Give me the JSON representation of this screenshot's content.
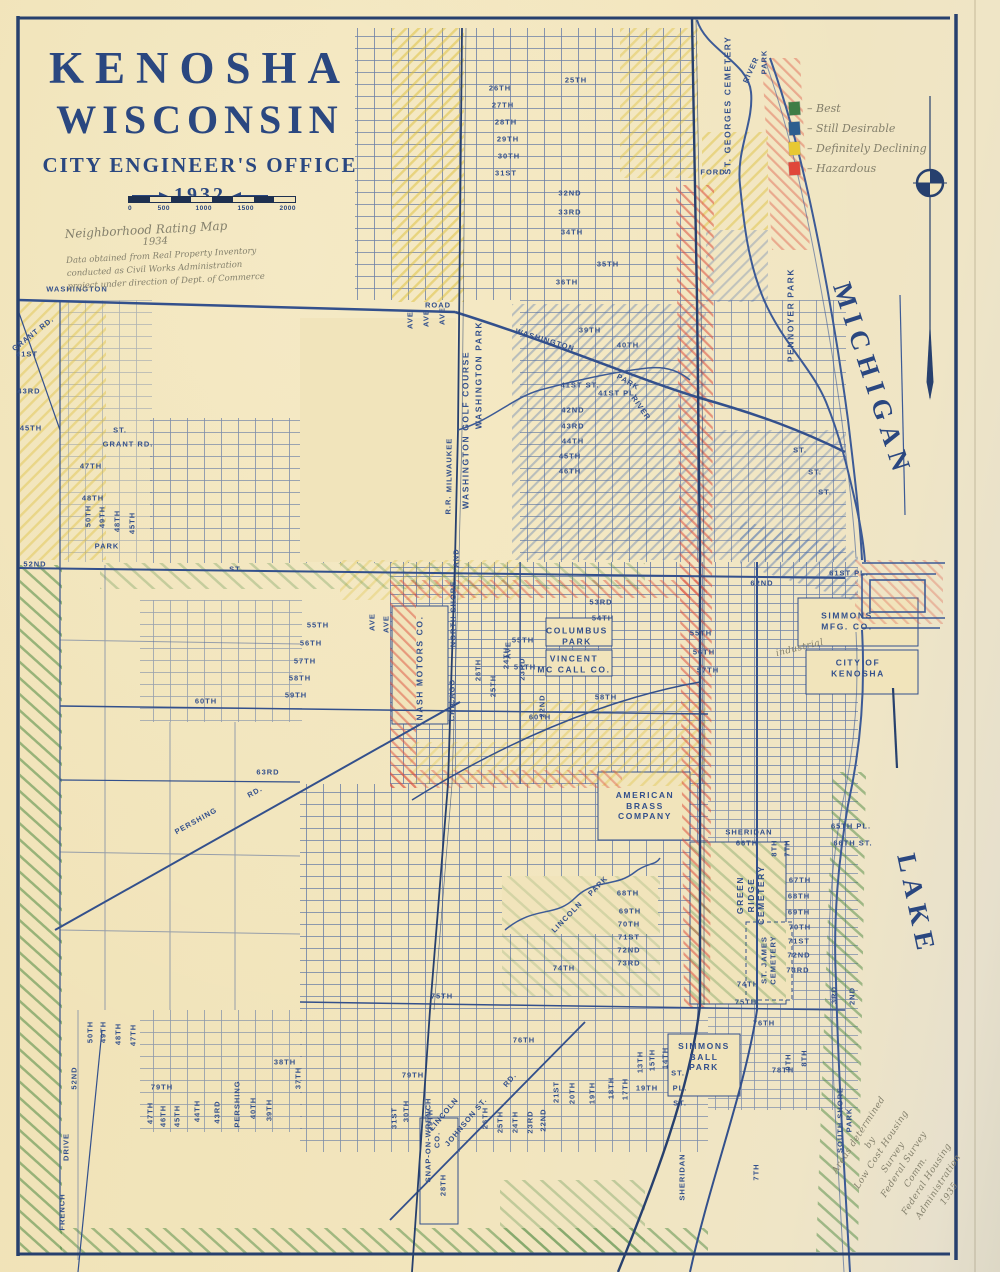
{
  "title": {
    "line1": "KENOSHA",
    "line2": "WISCONSIN",
    "office": "CITY ENGINEER'S OFFICE",
    "year": "1932"
  },
  "scale": {
    "ticks": [
      "0",
      "500",
      "1000",
      "1500",
      "2000"
    ]
  },
  "notes": {
    "top_title": "Neighborhood Rating Map",
    "top_year": "1934",
    "top_body": "Data obtained from Real Property Inventory\nconducted as Civil Works Administration\nproject under direction of Dept. of Commerce"
  },
  "legend": {
    "prefix": "– ",
    "items": [
      {
        "label": "Best",
        "color": "#3f7d46"
      },
      {
        "label": "Still Desirable",
        "color": "#2d5e8f"
      },
      {
        "label": "Definitely Declining",
        "color": "#e7c832"
      },
      {
        "label": "Hazardous",
        "color": "#e0473a"
      }
    ]
  },
  "colors": {
    "ink": "#2a4780",
    "street": "#33508c",
    "paper": "#f1e4bb",
    "pencil": "#84806c"
  },
  "map_labels": [
    {
      "t": "WASHINGTON",
      "x": 77,
      "y": 289,
      "r": 0,
      "c": "s"
    },
    {
      "t": "GRANT RD.",
      "x": 33,
      "y": 334,
      "r": -38,
      "c": "s"
    },
    {
      "t": "41ST",
      "x": 27,
      "y": 354,
      "r": 0,
      "c": "s"
    },
    {
      "t": "43RD",
      "x": 29,
      "y": 391,
      "r": 0,
      "c": "s"
    },
    {
      "t": "45TH",
      "x": 31,
      "y": 428,
      "r": 0,
      "c": "s"
    },
    {
      "t": "ST.",
      "x": 120,
      "y": 430,
      "r": 0,
      "c": "s"
    },
    {
      "t": "GRANT RD.",
      "x": 128,
      "y": 444,
      "r": 0,
      "c": "s"
    },
    {
      "t": "47TH",
      "x": 91,
      "y": 466,
      "r": 0,
      "c": "s"
    },
    {
      "t": "48TH",
      "x": 93,
      "y": 498,
      "r": 0,
      "c": "s"
    },
    {
      "t": "50TH",
      "x": 88,
      "y": 516,
      "r": -90,
      "c": "s"
    },
    {
      "t": "49TH",
      "x": 102,
      "y": 517,
      "r": -90,
      "c": "s"
    },
    {
      "t": "48TH",
      "x": 117,
      "y": 521,
      "r": -90,
      "c": "s"
    },
    {
      "t": "45TH",
      "x": 132,
      "y": 523,
      "r": -90,
      "c": "s"
    },
    {
      "t": "PARK",
      "x": 107,
      "y": 546,
      "r": 0,
      "c": "s"
    },
    {
      "t": "52ND",
      "x": 35,
      "y": 564,
      "r": 0,
      "c": "s"
    },
    {
      "t": "ST.",
      "x": 236,
      "y": 569,
      "r": 0,
      "c": "s"
    },
    {
      "t": "55TH",
      "x": 318,
      "y": 625,
      "r": 0,
      "c": "s"
    },
    {
      "t": "56TH",
      "x": 311,
      "y": 643,
      "r": 0,
      "c": "s"
    },
    {
      "t": "57TH",
      "x": 305,
      "y": 661,
      "r": 0,
      "c": "s"
    },
    {
      "t": "58TH",
      "x": 300,
      "y": 678,
      "r": 0,
      "c": "s"
    },
    {
      "t": "59TH",
      "x": 296,
      "y": 695,
      "r": 0,
      "c": "s"
    },
    {
      "t": "60TH",
      "x": 206,
      "y": 701,
      "r": 0,
      "c": "s"
    },
    {
      "t": "63RD",
      "x": 268,
      "y": 772,
      "r": 0,
      "c": "s"
    },
    {
      "t": "PERSHING",
      "x": 196,
      "y": 821,
      "r": -29,
      "c": "s"
    },
    {
      "t": "RD.",
      "x": 255,
      "y": 792,
      "r": -29,
      "c": "s"
    },
    {
      "t": "25TH",
      "x": 576,
      "y": 80,
      "r": 0,
      "c": "s"
    },
    {
      "t": "26TH",
      "x": 500,
      "y": 88,
      "r": 0,
      "c": "s"
    },
    {
      "t": "27TH",
      "x": 503,
      "y": 105,
      "r": 0,
      "c": "s"
    },
    {
      "t": "28TH",
      "x": 506,
      "y": 122,
      "r": 0,
      "c": "s"
    },
    {
      "t": "29TH",
      "x": 508,
      "y": 139,
      "r": 0,
      "c": "s"
    },
    {
      "t": "30TH",
      "x": 509,
      "y": 156,
      "r": 0,
      "c": "s"
    },
    {
      "t": "31ST",
      "x": 506,
      "y": 173,
      "r": 0,
      "c": "s"
    },
    {
      "t": "32ND",
      "x": 570,
      "y": 193,
      "r": 0,
      "c": "s"
    },
    {
      "t": "33RD",
      "x": 570,
      "y": 212,
      "r": 0,
      "c": "s"
    },
    {
      "t": "34TH",
      "x": 572,
      "y": 232,
      "r": 0,
      "c": "s"
    },
    {
      "t": "35TH",
      "x": 608,
      "y": 264,
      "r": 0,
      "c": "s"
    },
    {
      "t": "36TH",
      "x": 567,
      "y": 282,
      "r": 0,
      "c": "s"
    },
    {
      "t": "ROAD",
      "x": 438,
      "y": 305,
      "r": 0,
      "c": "s"
    },
    {
      "t": "WASHINGTON",
      "x": 545,
      "y": 340,
      "r": 17,
      "c": "s"
    },
    {
      "t": "PARK",
      "x": 628,
      "y": 382,
      "r": 30,
      "c": "s"
    },
    {
      "t": "RIVER",
      "x": 641,
      "y": 408,
      "r": 55,
      "c": "s"
    },
    {
      "t": "39TH",
      "x": 590,
      "y": 330,
      "r": 0,
      "c": "s"
    },
    {
      "t": "40TH",
      "x": 628,
      "y": 345,
      "r": 0,
      "c": "s"
    },
    {
      "t": "41ST ST.",
      "x": 580,
      "y": 385,
      "r": 0,
      "c": "s"
    },
    {
      "t": "41ST PL.",
      "x": 618,
      "y": 393,
      "r": 0,
      "c": "s"
    },
    {
      "t": "42ND",
      "x": 573,
      "y": 410,
      "r": 0,
      "c": "s"
    },
    {
      "t": "43RD",
      "x": 573,
      "y": 426,
      "r": 0,
      "c": "s"
    },
    {
      "t": "44TH",
      "x": 573,
      "y": 441,
      "r": 0,
      "c": "s"
    },
    {
      "t": "45TH",
      "x": 570,
      "y": 456,
      "r": 0,
      "c": "s"
    },
    {
      "t": "46TH",
      "x": 570,
      "y": 471,
      "r": 0,
      "c": "s"
    },
    {
      "t": "WASHINGTON PARK",
      "x": 479,
      "y": 375,
      "r": -90,
      "c": "ps"
    },
    {
      "t": "WASHINGTON GOLF COURSE",
      "x": 466,
      "y": 430,
      "r": -90,
      "c": "ps"
    },
    {
      "t": "MILWAUKEE",
      "x": 449,
      "y": 465,
      "r": -90,
      "c": "s"
    },
    {
      "t": "R.R.",
      "x": 448,
      "y": 505,
      "r": -90,
      "c": "s"
    },
    {
      "t": "AND",
      "x": 456,
      "y": 558,
      "r": -90,
      "c": "s"
    },
    {
      "t": "NORTH SHORE",
      "x": 453,
      "y": 614,
      "r": -90,
      "c": "s"
    },
    {
      "t": "CHICAGO",
      "x": 452,
      "y": 700,
      "r": -90,
      "c": "s"
    },
    {
      "t": "NASH MOTORS CO.",
      "x": 420,
      "y": 668,
      "r": -90,
      "c": "ps"
    },
    {
      "t": "ST. GEORGES CEMETERY",
      "x": 728,
      "y": 105,
      "r": -90,
      "c": "ps"
    },
    {
      "t": "RIVER",
      "x": 751,
      "y": 70,
      "r": -65,
      "c": "s"
    },
    {
      "t": "PARK",
      "x": 764,
      "y": 62,
      "r": -90,
      "c": "s"
    },
    {
      "t": "FORD",
      "x": 713,
      "y": 172,
      "r": 0,
      "c": "s"
    },
    {
      "t": "PENNOYER PARK",
      "x": 791,
      "y": 315,
      "r": -90,
      "c": "ps"
    },
    {
      "t": "ST.",
      "x": 800,
      "y": 450,
      "r": 0,
      "c": "s"
    },
    {
      "t": "ST.",
      "x": 815,
      "y": 472,
      "r": 0,
      "c": "s"
    },
    {
      "t": "ST.",
      "x": 825,
      "y": 492,
      "r": 0,
      "c": "s"
    },
    {
      "t": "53RD",
      "x": 601,
      "y": 602,
      "r": 0,
      "c": "s"
    },
    {
      "t": "54TH",
      "x": 603,
      "y": 618,
      "r": 0,
      "c": "s"
    },
    {
      "t": "COLUMBUS\nPARK",
      "x": 577,
      "y": 636,
      "r": 0,
      "c": "ps"
    },
    {
      "t": "VINCENT\nMC CALL CO.",
      "x": 574,
      "y": 664,
      "r": 0,
      "c": "ps"
    },
    {
      "t": "55TH",
      "x": 523,
      "y": 640,
      "r": 0,
      "c": "s"
    },
    {
      "t": "56TH",
      "x": 525,
      "y": 667,
      "r": 0,
      "c": "s"
    },
    {
      "t": "26TH",
      "x": 478,
      "y": 670,
      "r": -90,
      "c": "s"
    },
    {
      "t": "25TH",
      "x": 493,
      "y": 686,
      "r": -90,
      "c": "s"
    },
    {
      "t": "24TH",
      "x": 506,
      "y": 658,
      "r": -90,
      "c": "s"
    },
    {
      "t": "23RD",
      "x": 522,
      "y": 669,
      "r": -90,
      "c": "s"
    },
    {
      "t": "22ND",
      "x": 542,
      "y": 706,
      "r": -90,
      "c": "s"
    },
    {
      "t": "55TH",
      "x": 701,
      "y": 633,
      "r": 0,
      "c": "s"
    },
    {
      "t": "56TH",
      "x": 704,
      "y": 652,
      "r": 0,
      "c": "s"
    },
    {
      "t": "57TH",
      "x": 708,
      "y": 670,
      "r": 0,
      "c": "s"
    },
    {
      "t": "58TH",
      "x": 606,
      "y": 697,
      "r": 0,
      "c": "s"
    },
    {
      "t": "60TH",
      "x": 540,
      "y": 717,
      "r": 0,
      "c": "s"
    },
    {
      "t": "62ND",
      "x": 762,
      "y": 583,
      "r": 0,
      "c": "s"
    },
    {
      "t": "61ST PL.",
      "x": 849,
      "y": 573,
      "r": 0,
      "c": "s"
    },
    {
      "t": "SIMMONS\nMFG. CO.",
      "x": 847,
      "y": 621,
      "r": 0,
      "c": "ps"
    },
    {
      "t": "CITY OF\nKENOSHA",
      "x": 858,
      "y": 668,
      "r": 0,
      "c": "ps"
    },
    {
      "t": "industrial",
      "x": 800,
      "y": 649,
      "r": -14,
      "c": "h"
    },
    {
      "t": "AMERICAN\nBRASS\nCOMPANY",
      "x": 645,
      "y": 806,
      "r": 0,
      "c": "ps"
    },
    {
      "t": "LINCOLN",
      "x": 567,
      "y": 917,
      "r": -46,
      "c": "s"
    },
    {
      "t": "PARK",
      "x": 598,
      "y": 886,
      "r": -46,
      "c": "s"
    },
    {
      "t": "68TH",
      "x": 628,
      "y": 893,
      "r": 0,
      "c": "s"
    },
    {
      "t": "69TH",
      "x": 630,
      "y": 911,
      "r": 0,
      "c": "s"
    },
    {
      "t": "70TH",
      "x": 629,
      "y": 924,
      "r": 0,
      "c": "s"
    },
    {
      "t": "71ST",
      "x": 629,
      "y": 937,
      "r": 0,
      "c": "s"
    },
    {
      "t": "72ND",
      "x": 629,
      "y": 950,
      "r": 0,
      "c": "s"
    },
    {
      "t": "73RD",
      "x": 629,
      "y": 963,
      "r": 0,
      "c": "s"
    },
    {
      "t": "74TH",
      "x": 564,
      "y": 968,
      "r": 0,
      "c": "s"
    },
    {
      "t": "GREEN\nRIDGE\nCEMETERY",
      "x": 751,
      "y": 895,
      "r": -90,
      "c": "ps"
    },
    {
      "t": "ST. JAMES\nCEMETERY",
      "x": 769,
      "y": 960,
      "r": -90,
      "c": "s"
    },
    {
      "t": "SHERIDAN",
      "x": 749,
      "y": 832,
      "r": 0,
      "c": "s"
    },
    {
      "t": "66TH",
      "x": 747,
      "y": 843,
      "r": 0,
      "c": "s"
    },
    {
      "t": "8TH",
      "x": 774,
      "y": 848,
      "r": -90,
      "c": "s"
    },
    {
      "t": "7TH",
      "x": 787,
      "y": 848,
      "r": -90,
      "c": "s"
    },
    {
      "t": "65TH PL.",
      "x": 851,
      "y": 826,
      "r": 0,
      "c": "s"
    },
    {
      "t": "66TH ST.",
      "x": 853,
      "y": 843,
      "r": 0,
      "c": "s"
    },
    {
      "t": "67TH",
      "x": 800,
      "y": 880,
      "r": 0,
      "c": "s"
    },
    {
      "t": "68TH",
      "x": 799,
      "y": 896,
      "r": 0,
      "c": "s"
    },
    {
      "t": "69TH",
      "x": 799,
      "y": 912,
      "r": 0,
      "c": "s"
    },
    {
      "t": "70TH",
      "x": 800,
      "y": 927,
      "r": 0,
      "c": "s"
    },
    {
      "t": "71ST",
      "x": 799,
      "y": 941,
      "r": 0,
      "c": "s"
    },
    {
      "t": "72ND",
      "x": 799,
      "y": 955,
      "r": 0,
      "c": "s"
    },
    {
      "t": "73RD",
      "x": 798,
      "y": 970,
      "r": 0,
      "c": "s"
    },
    {
      "t": "74TH",
      "x": 748,
      "y": 984,
      "r": 0,
      "c": "s"
    },
    {
      "t": "75TH",
      "x": 746,
      "y": 1002,
      "r": 0,
      "c": "s"
    },
    {
      "t": "76TH",
      "x": 764,
      "y": 1023,
      "r": 0,
      "c": "s"
    },
    {
      "t": "3RD",
      "x": 834,
      "y": 995,
      "r": -90,
      "c": "s"
    },
    {
      "t": "2ND",
      "x": 852,
      "y": 996,
      "r": -90,
      "c": "s"
    },
    {
      "t": "9TH",
      "x": 788,
      "y": 1062,
      "r": -90,
      "c": "s"
    },
    {
      "t": "8TH",
      "x": 804,
      "y": 1058,
      "r": -90,
      "c": "s"
    },
    {
      "t": "78TH",
      "x": 783,
      "y": 1070,
      "r": 0,
      "c": "s"
    },
    {
      "t": "SIMMONS\nBALL\nPARK",
      "x": 704,
      "y": 1057,
      "r": 0,
      "c": "ps"
    },
    {
      "t": "SHERIDAN",
      "x": 682,
      "y": 1177,
      "r": -90,
      "c": "s"
    },
    {
      "t": "7TH",
      "x": 756,
      "y": 1172,
      "r": -90,
      "c": "s"
    },
    {
      "t": "14TH",
      "x": 665,
      "y": 1058,
      "r": -90,
      "c": "s"
    },
    {
      "t": "15TH",
      "x": 652,
      "y": 1060,
      "r": -90,
      "c": "s"
    },
    {
      "t": "13TH",
      "x": 640,
      "y": 1062,
      "r": -90,
      "c": "s"
    },
    {
      "t": "18TH",
      "x": 611,
      "y": 1088,
      "r": -90,
      "c": "s"
    },
    {
      "t": "17TH",
      "x": 625,
      "y": 1089,
      "r": -90,
      "c": "s"
    },
    {
      "t": "19TH",
      "x": 647,
      "y": 1088,
      "r": 0,
      "c": "s"
    },
    {
      "t": "ST.",
      "x": 678,
      "y": 1073,
      "r": 0,
      "c": "s"
    },
    {
      "t": "PL.",
      "x": 680,
      "y": 1088,
      "r": 0,
      "c": "s"
    },
    {
      "t": "ST.",
      "x": 680,
      "y": 1103,
      "r": 0,
      "c": "s"
    },
    {
      "t": "SNAP-ON-WRENCH\nCO.",
      "x": 433,
      "y": 1140,
      "r": -90,
      "c": "s"
    },
    {
      "t": "28TH",
      "x": 443,
      "y": 1185,
      "r": -90,
      "c": "s"
    },
    {
      "t": "LINCOLN",
      "x": 444,
      "y": 1114,
      "r": -50,
      "c": "s"
    },
    {
      "t": "RD.",
      "x": 510,
      "y": 1080,
      "r": -50,
      "c": "s"
    },
    {
      "t": "JOHNSON ST.",
      "x": 466,
      "y": 1122,
      "r": -50,
      "c": "s"
    },
    {
      "t": "30TH",
      "x": 406,
      "y": 1111,
      "r": -90,
      "c": "s"
    },
    {
      "t": "31ST",
      "x": 394,
      "y": 1118,
      "r": -90,
      "c": "s"
    },
    {
      "t": "29TH",
      "x": 430,
      "y": 1120,
      "r": -90,
      "c": "s"
    },
    {
      "t": "79TH",
      "x": 413,
      "y": 1075,
      "r": 0,
      "c": "s"
    },
    {
      "t": "21ST",
      "x": 556,
      "y": 1092,
      "r": -90,
      "c": "s"
    },
    {
      "t": "20TH",
      "x": 572,
      "y": 1093,
      "r": -90,
      "c": "s"
    },
    {
      "t": "19TH",
      "x": 592,
      "y": 1093,
      "r": -90,
      "c": "s"
    },
    {
      "t": "22ND",
      "x": 543,
      "y": 1120,
      "r": -90,
      "c": "s"
    },
    {
      "t": "23RD",
      "x": 530,
      "y": 1122,
      "r": -90,
      "c": "s"
    },
    {
      "t": "24TH",
      "x": 515,
      "y": 1122,
      "r": -90,
      "c": "s"
    },
    {
      "t": "25TH",
      "x": 500,
      "y": 1122,
      "r": -90,
      "c": "s"
    },
    {
      "t": "26TH",
      "x": 485,
      "y": 1118,
      "r": -90,
      "c": "s"
    },
    {
      "t": "75TH",
      "x": 442,
      "y": 996,
      "r": 0,
      "c": "s"
    },
    {
      "t": "76TH",
      "x": 524,
      "y": 1040,
      "r": 0,
      "c": "s"
    },
    {
      "t": "50TH",
      "x": 90,
      "y": 1032,
      "r": -90,
      "c": "s"
    },
    {
      "t": "49TH",
      "x": 103,
      "y": 1032,
      "r": -90,
      "c": "s"
    },
    {
      "t": "48TH",
      "x": 118,
      "y": 1034,
      "r": -90,
      "c": "s"
    },
    {
      "t": "47TH",
      "x": 133,
      "y": 1035,
      "r": -90,
      "c": "s"
    },
    {
      "t": "52ND",
      "x": 74,
      "y": 1078,
      "r": -90,
      "c": "s"
    },
    {
      "t": "DRIVE",
      "x": 66,
      "y": 1147,
      "r": -90,
      "c": "s"
    },
    {
      "t": "FRENCH",
      "x": 62,
      "y": 1212,
      "r": -90,
      "c": "s"
    },
    {
      "t": "79TH",
      "x": 162,
      "y": 1087,
      "r": 0,
      "c": "s"
    },
    {
      "t": "47TH",
      "x": 150,
      "y": 1113,
      "r": -90,
      "c": "s"
    },
    {
      "t": "46TH",
      "x": 163,
      "y": 1116,
      "r": -90,
      "c": "s"
    },
    {
      "t": "45TH",
      "x": 177,
      "y": 1116,
      "r": -90,
      "c": "s"
    },
    {
      "t": "44TH",
      "x": 197,
      "y": 1111,
      "r": -90,
      "c": "s"
    },
    {
      "t": "43RD",
      "x": 217,
      "y": 1112,
      "r": -90,
      "c": "s"
    },
    {
      "t": "PERSHING",
      "x": 237,
      "y": 1104,
      "r": -90,
      "c": "s"
    },
    {
      "t": "40TH",
      "x": 253,
      "y": 1108,
      "r": -90,
      "c": "s"
    },
    {
      "t": "39TH",
      "x": 269,
      "y": 1110,
      "r": -90,
      "c": "s"
    },
    {
      "t": "38TH",
      "x": 285,
      "y": 1062,
      "r": 0,
      "c": "s"
    },
    {
      "t": "37TH",
      "x": 298,
      "y": 1078,
      "r": -90,
      "c": "s"
    },
    {
      "t": "SOUTH SHORE\nPARK",
      "x": 845,
      "y": 1120,
      "r": -90,
      "c": "s"
    },
    {
      "t": "AVE",
      "x": 410,
      "y": 320,
      "r": -90,
      "c": "s"
    },
    {
      "t": "AVE",
      "x": 426,
      "y": 318,
      "r": -90,
      "c": "s"
    },
    {
      "t": "AVE",
      "x": 442,
      "y": 316,
      "r": -90,
      "c": "s"
    },
    {
      "t": "AVE",
      "x": 372,
      "y": 622,
      "r": -90,
      "c": "s"
    },
    {
      "t": "AVE",
      "x": 386,
      "y": 624,
      "r": -90,
      "c": "s"
    },
    {
      "t": "AVE",
      "x": 508,
      "y": 650,
      "r": -90,
      "c": "s"
    },
    {
      "t": "LAKE",
      "x": 916,
      "y": 905,
      "r": 78,
      "c": "w"
    },
    {
      "t": "MICHIGAN",
      "x": 872,
      "y": 380,
      "r": 72,
      "c": "w"
    },
    {
      "t": "Areas determined by\nLow Cost Housing Survey\nFederal Survey Comm.\nFederal Housing Administration\n1935",
      "x": 905,
      "y": 1165,
      "r": -57,
      "c": "h"
    }
  ]
}
